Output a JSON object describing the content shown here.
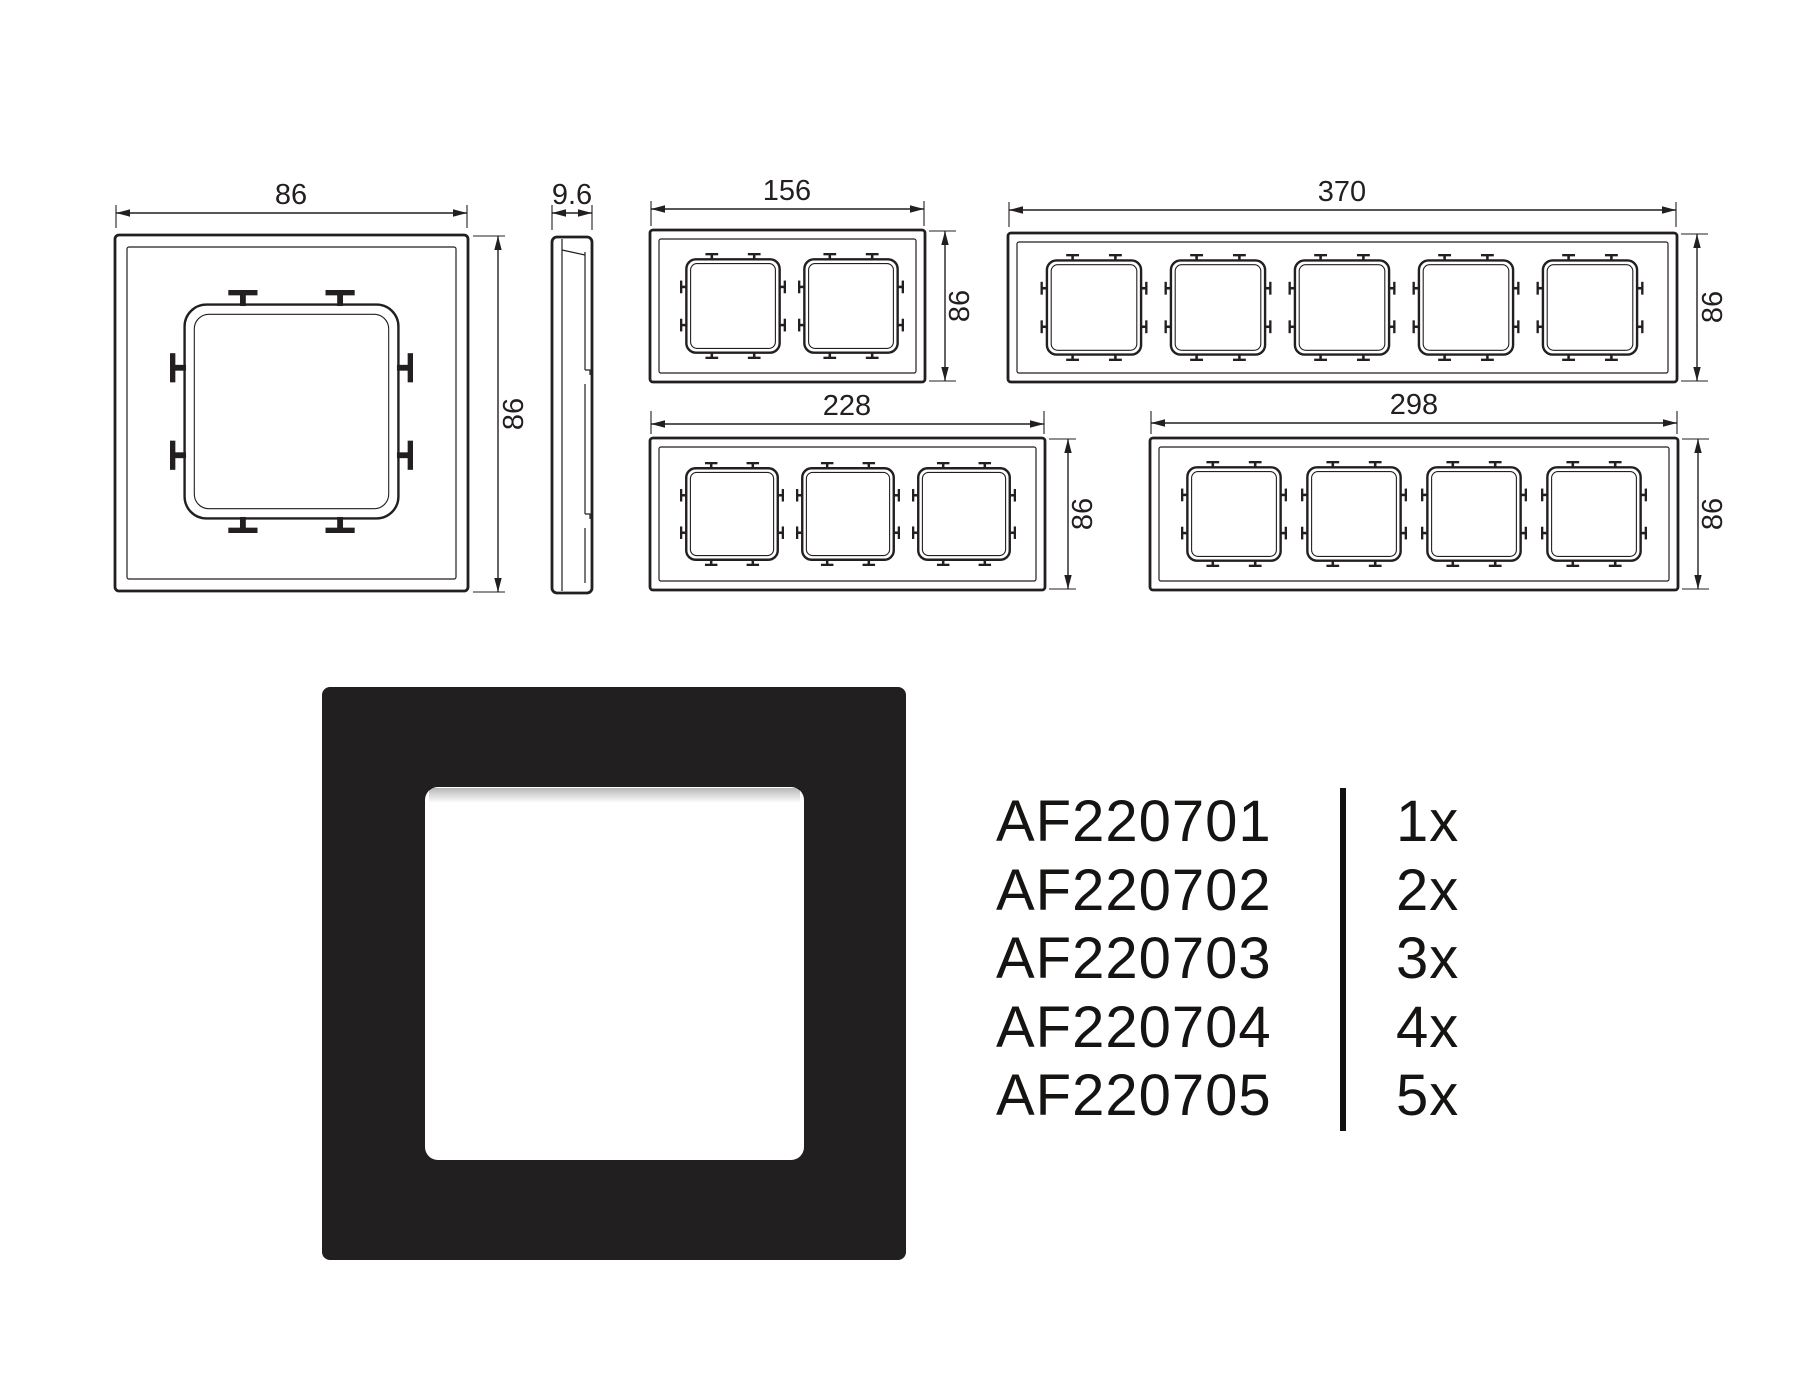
{
  "drawings": {
    "line_color": "#231f20",
    "single": {
      "width": "86",
      "height": "86"
    },
    "side": {
      "depth": "9.6"
    },
    "gang2": {
      "width": "156",
      "height": "86"
    },
    "gang3": {
      "width": "228",
      "height": "86"
    },
    "gang4": {
      "width": "298",
      "height": "86"
    },
    "gang5": {
      "width": "370",
      "height": "86"
    }
  },
  "product_photo": {
    "frame_color": "#221f20",
    "window_color": "#ffffff"
  },
  "part_list": {
    "rows": [
      {
        "code": "AF220701",
        "qty": "1x"
      },
      {
        "code": "AF220702",
        "qty": "2x"
      },
      {
        "code": "AF220703",
        "qty": "3x"
      },
      {
        "code": "AF220704",
        "qty": "4x"
      },
      {
        "code": "AF220705",
        "qty": "5x"
      }
    ]
  }
}
